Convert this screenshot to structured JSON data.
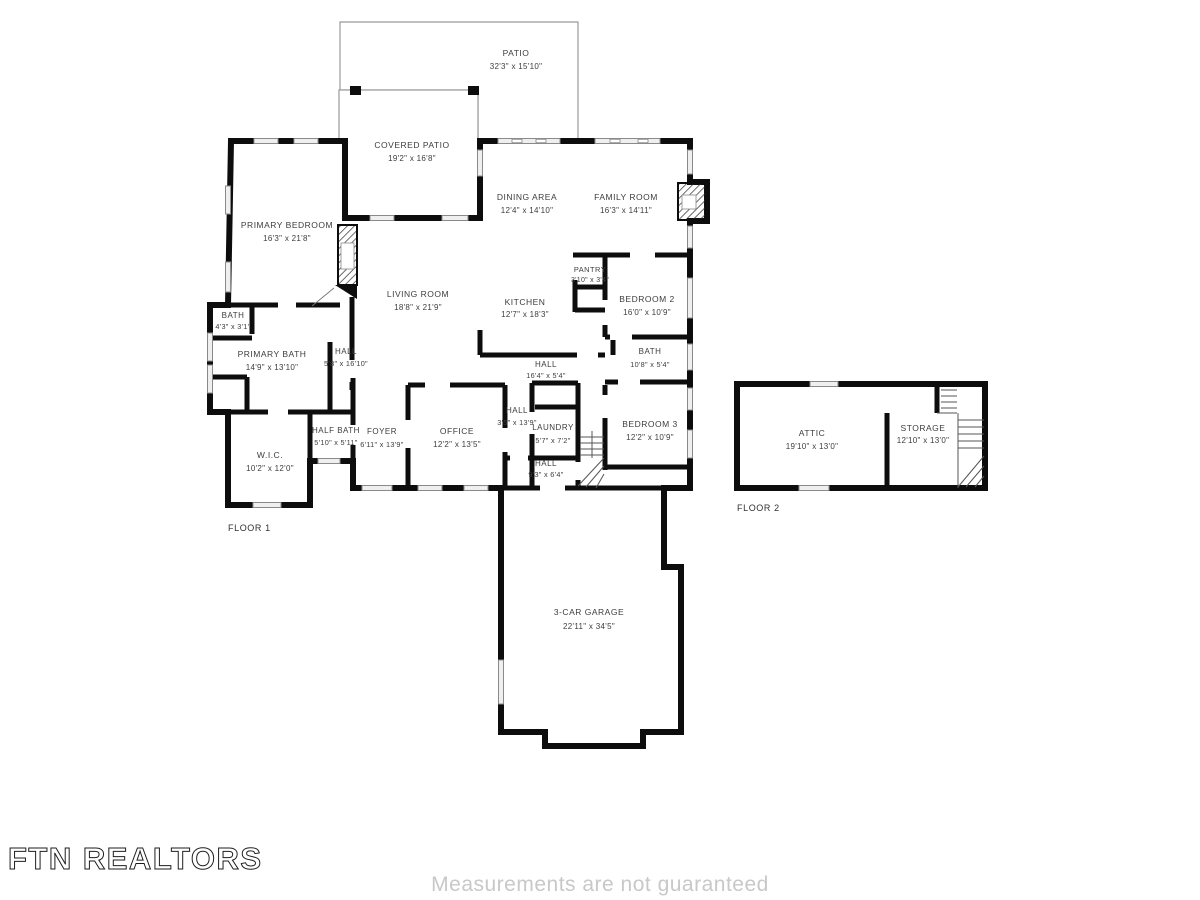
{
  "meta": {
    "document_type": "Residential floor plan",
    "colors": {
      "wall": "#0d0d0d",
      "thin_outline": "#9a9a9a",
      "label_text": "#3d3d3d",
      "disclaimer_text": "#c8c8c8"
    }
  },
  "floor1": {
    "label": "FLOOR 1",
    "rooms": [
      {
        "name": "PATIO",
        "dims": "32'3\" x 15'10\""
      },
      {
        "name": "COVERED PATIO",
        "dims": "19'2\" x 16'8\""
      },
      {
        "name": "DINING AREA",
        "dims": "12'4\" x 14'10\""
      },
      {
        "name": "FAMILY ROOM",
        "dims": "16'3\" x 14'11\""
      },
      {
        "name": "PRIMARY BEDROOM",
        "dims": "16'3\" x 21'8\""
      },
      {
        "name": "LIVING ROOM",
        "dims": "18'8\" x 21'9\""
      },
      {
        "name": "KITCHEN",
        "dims": "12'7\" x 18'3\""
      },
      {
        "name": "PANTRY",
        "dims": "3'10\" x 3'4\""
      },
      {
        "name": "BEDROOM 2",
        "dims": "16'0\" x 10'9\""
      },
      {
        "name": "BATH",
        "dims": "4'3\" x 3'1\""
      },
      {
        "name": "PRIMARY BATH",
        "dims": "14'9\" x 13'10\""
      },
      {
        "name": "HALL",
        "dims": "5'8\" x 16'10\""
      },
      {
        "name": "BATH",
        "dims": "10'8\" x 5'4\""
      },
      {
        "name": "HALL",
        "dims": "16'4\" x 5'4\""
      },
      {
        "name": "HALL",
        "dims": "3'5\" x 13'9\""
      },
      {
        "name": "LAUNDRY",
        "dims": "5'7\" x 7'2\""
      },
      {
        "name": "HALL",
        "dims": "9'3\" x 6'4\""
      },
      {
        "name": "BEDROOM 3",
        "dims": "12'2\" x 10'9\""
      },
      {
        "name": "OFFICE",
        "dims": "12'2\" x 13'5\""
      },
      {
        "name": "FOYER",
        "dims": "6'11\" x 13'9\""
      },
      {
        "name": "HALF BATH",
        "dims": "5'10\" x 5'11\""
      },
      {
        "name": "W.I.C.",
        "dims": "10'2\" x 12'0\""
      },
      {
        "name": "3-CAR GARAGE",
        "dims": "22'11\" x 34'5\""
      }
    ]
  },
  "floor2": {
    "label": "FLOOR 2",
    "rooms": [
      {
        "name": "ATTIC",
        "dims": "19'10\" x 13'0\""
      },
      {
        "name": "STORAGE",
        "dims": "12'10\" x 13'0\""
      }
    ]
  },
  "footer": {
    "brand": "FTN REALTORS",
    "disclaimer": "Measurements are not guaranteed"
  }
}
